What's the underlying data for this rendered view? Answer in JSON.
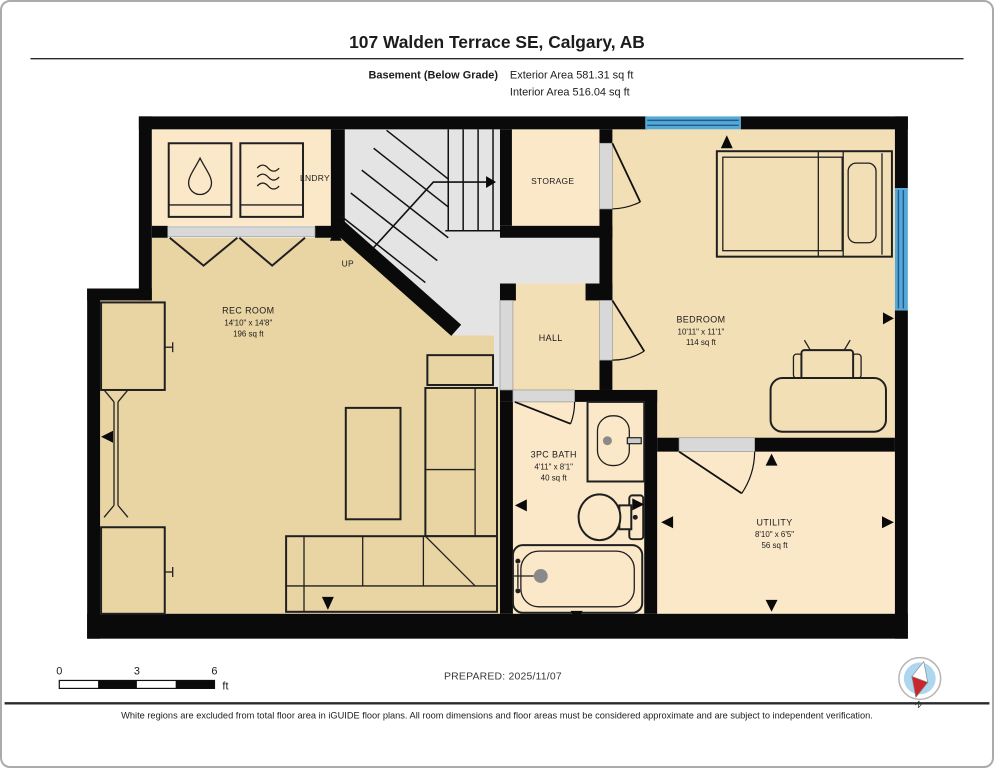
{
  "header": {
    "title": "107 Walden Terrace SE, Calgary, AB",
    "floor_label": "Basement (Below Grade)",
    "exterior_area": "Exterior Area 581.31 sq ft",
    "interior_area": "Interior Area 516.04 sq ft"
  },
  "rooms": {
    "laundry": {
      "name": "LNDRY"
    },
    "stairs": {
      "direction": "UP"
    },
    "storage": {
      "name": "STORAGE"
    },
    "rec_room": {
      "name": "REC ROOM",
      "dimensions": "14'10\" x 14'8\"",
      "area": "196 sq ft"
    },
    "hall": {
      "name": "HALL"
    },
    "bedroom": {
      "name": "BEDROOM",
      "dimensions": "10'11\" x 11'1\"",
      "area": "114 sq ft"
    },
    "bath": {
      "name": "3PC BATH",
      "dimensions": "4'11\" x 8'1\"",
      "area": "40 sq ft"
    },
    "utility": {
      "name": "UTILITY",
      "dimensions": "8'10\" x 6'5\"",
      "area": "56 sq ft"
    }
  },
  "scale_bar": {
    "start": "0",
    "mid": "3",
    "end": "6",
    "unit": "ft"
  },
  "footer": {
    "prepared": "PREPARED: 2025/11/07",
    "compass_north": "N",
    "disclaimer": "White regions are excluded from total floor area in iGUIDE floor plans. All room dimensions and floor areas must be considered approximate and are subject to independent verification."
  },
  "colors": {
    "wall": "#0a0a0a",
    "floor_light": "#fbe8c9",
    "floor_medium": "#f3dfb6",
    "floor_dark": "#e9d4a4",
    "stair_gray": "#e4e4e4",
    "threshold_gray": "#d8d8d8",
    "window_blue": "#58a8d5",
    "compass_blue": "#add6ef",
    "compass_red": "#c9252c"
  }
}
